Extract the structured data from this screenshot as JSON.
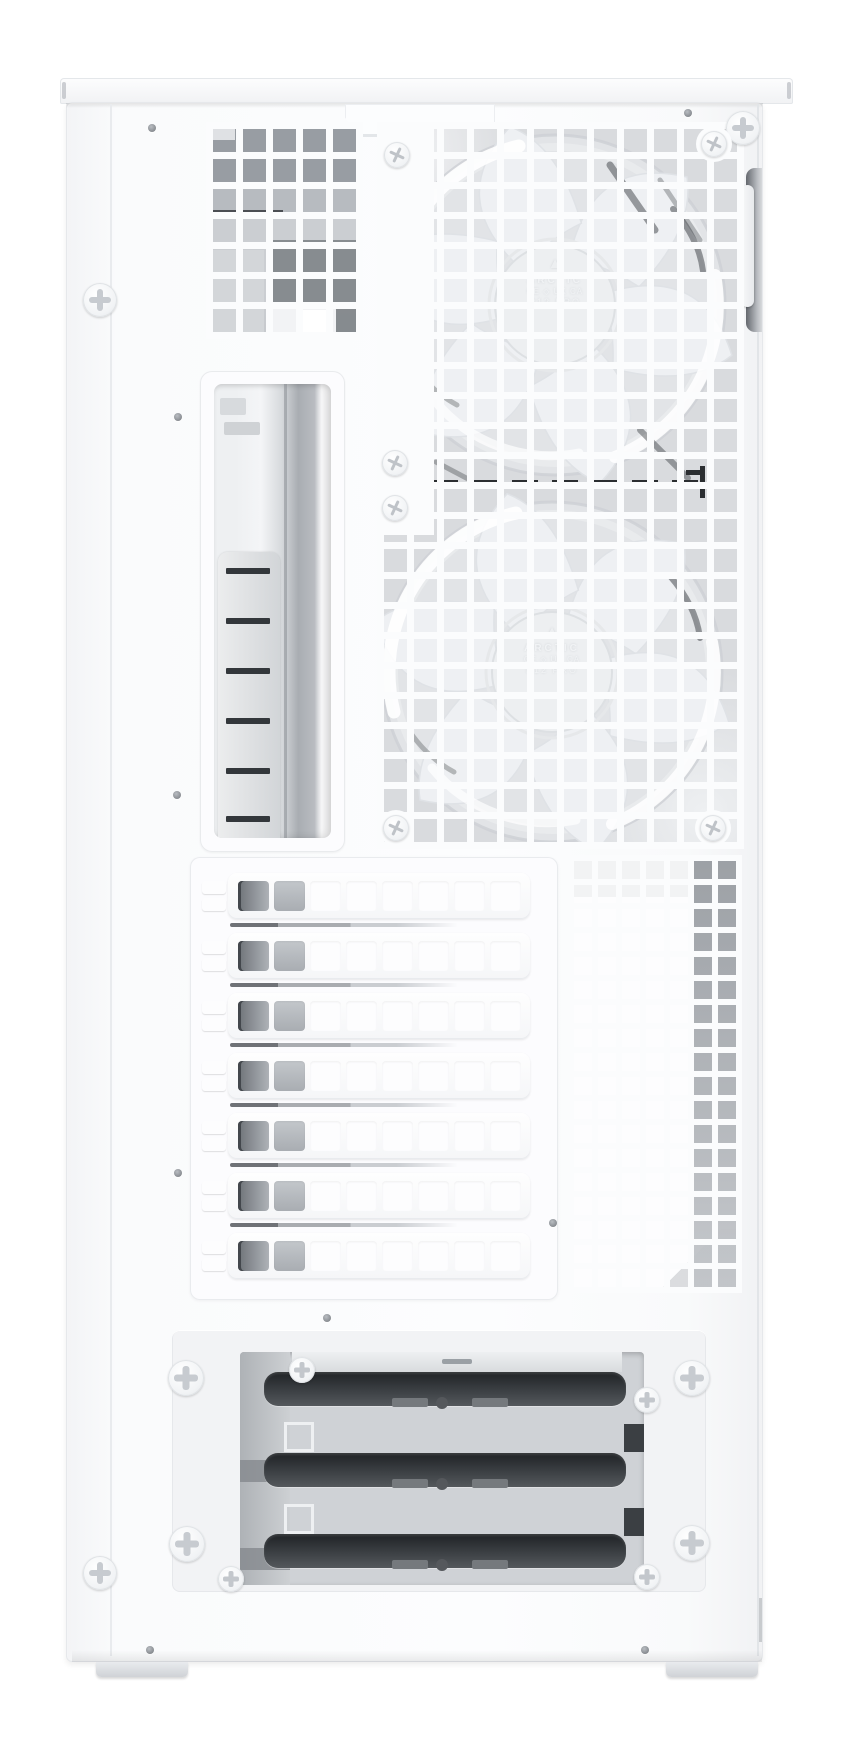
{
  "scene": {
    "description": "Rear-quarter product photo of a white ATX PC tower case with ventilated mesh panels, two pre-installed 120 mm white fans, seven vented expansion slot covers and a bottom drive cage",
    "background_color": "#ffffff",
    "case_color": "#fbfcfd",
    "mesh_interior_color": "#d9dbde",
    "drive_slot_color": "#2e3236",
    "hardware_color": "#f1f3f5"
  },
  "fan_hub": {
    "logo_glyph": "▲",
    "brand": "ARCTIC",
    "cert_marks": "CE ◇ UK CA",
    "model": "P12 PRO"
  },
  "counts": {
    "fans": 2,
    "expansion_slot_covers": 7,
    "vent_holes_per_cover": 8,
    "drive_bays": 3,
    "thumbscrews": 7,
    "panel_screws": 10,
    "rivets": 9
  }
}
